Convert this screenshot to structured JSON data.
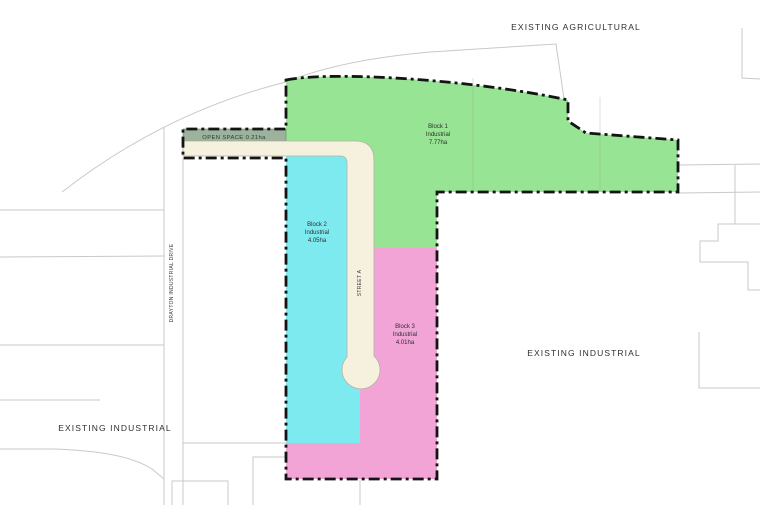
{
  "title": "Industrial Subdivision Concept Plan",
  "colors": {
    "block1": "#97e494",
    "block2": "#7deaf0",
    "block3": "#f2a4d7",
    "open_space": "#9cb29c",
    "road": "#f6f0de",
    "road_outline": "#b8b19e",
    "boundary": "#141414",
    "parcel_line": "#c9c9c9"
  },
  "labels": {
    "existing_agricultural": "EXISTING AGRICULTURAL",
    "existing_industrial_right": "EXISTING INDUSTRIAL",
    "existing_industrial_left": "EXISTING INDUSTRIAL",
    "drayton_industrial_drive": "DRAYTON INDUSTRIAL DRIVE",
    "street_a": "STREET A",
    "open_space": "OPEN SPACE 0.21ha"
  },
  "blocks": [
    {
      "name": "Block 1",
      "zoning": "Industrial",
      "area": "7.77ha"
    },
    {
      "name": "Block 2",
      "zoning": "Industrial",
      "area": "4.05ha"
    },
    {
      "name": "Block 3",
      "zoning": "Industrial",
      "area": "4.01ha"
    }
  ]
}
